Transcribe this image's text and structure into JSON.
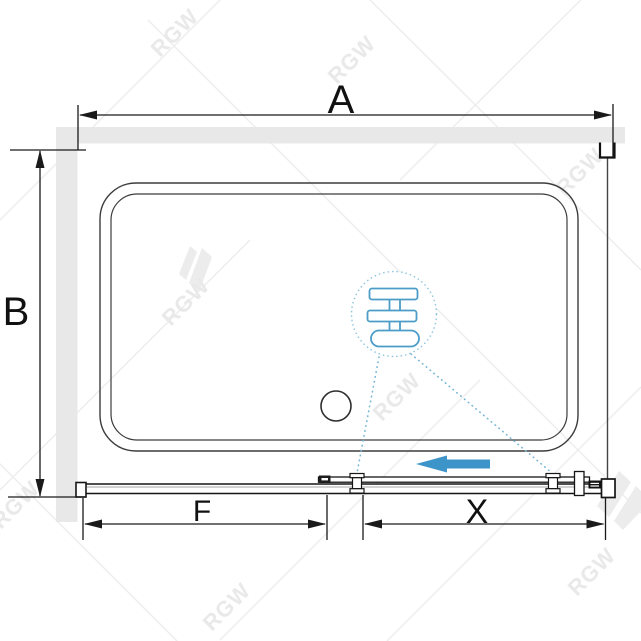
{
  "diagram": {
    "title": "shower-enclosure-top-view",
    "dimension_labels": {
      "width": "A",
      "depth": "B",
      "fixed_panel": "F",
      "door": "X"
    },
    "watermark_brand": "RGW",
    "icons": {
      "slide_direction_arrow": "left-arrow",
      "detail_callout": "roller-assembly-detail",
      "drain": "drain-circle"
    },
    "colors": {
      "arrow_blue": "#3d94c9",
      "detail_blue": "#4b9dc8",
      "leader_blue": "#79b7d6",
      "callout_blue": "#8ec4de",
      "wall_gray": "#e8e8e8",
      "line_black": "#1a1a1a",
      "watermark_gray": "#ececec"
    }
  }
}
